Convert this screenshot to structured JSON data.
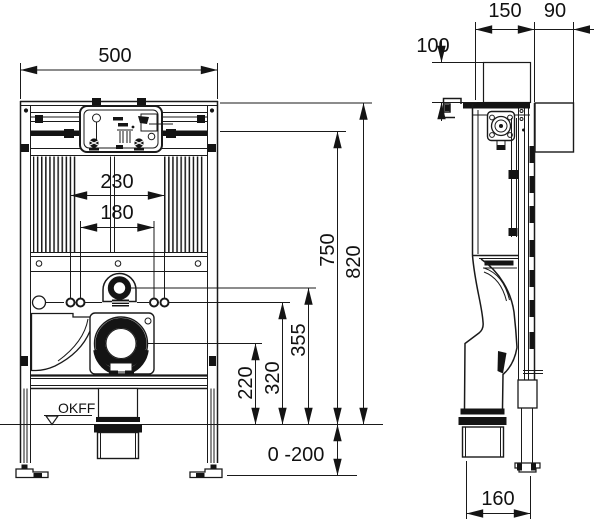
{
  "drawing": {
    "dims": {
      "front_width": "500",
      "anchor_spacing_outer": "230",
      "anchor_spacing_inner": "180",
      "outlet_height": "220",
      "anchor_height": "320",
      "water_connection_height": "355",
      "frame_upper_height": "750",
      "frame_total_height": "820",
      "foot_adjustment_range": "0 -200",
      "floor_level_label": "OKFF",
      "side_depth": "150",
      "side_wall_offset": "90",
      "side_top_height": "100",
      "side_base_depth": "160"
    },
    "colors": {
      "line": "#1a1a1a",
      "background": "#ffffff"
    }
  }
}
